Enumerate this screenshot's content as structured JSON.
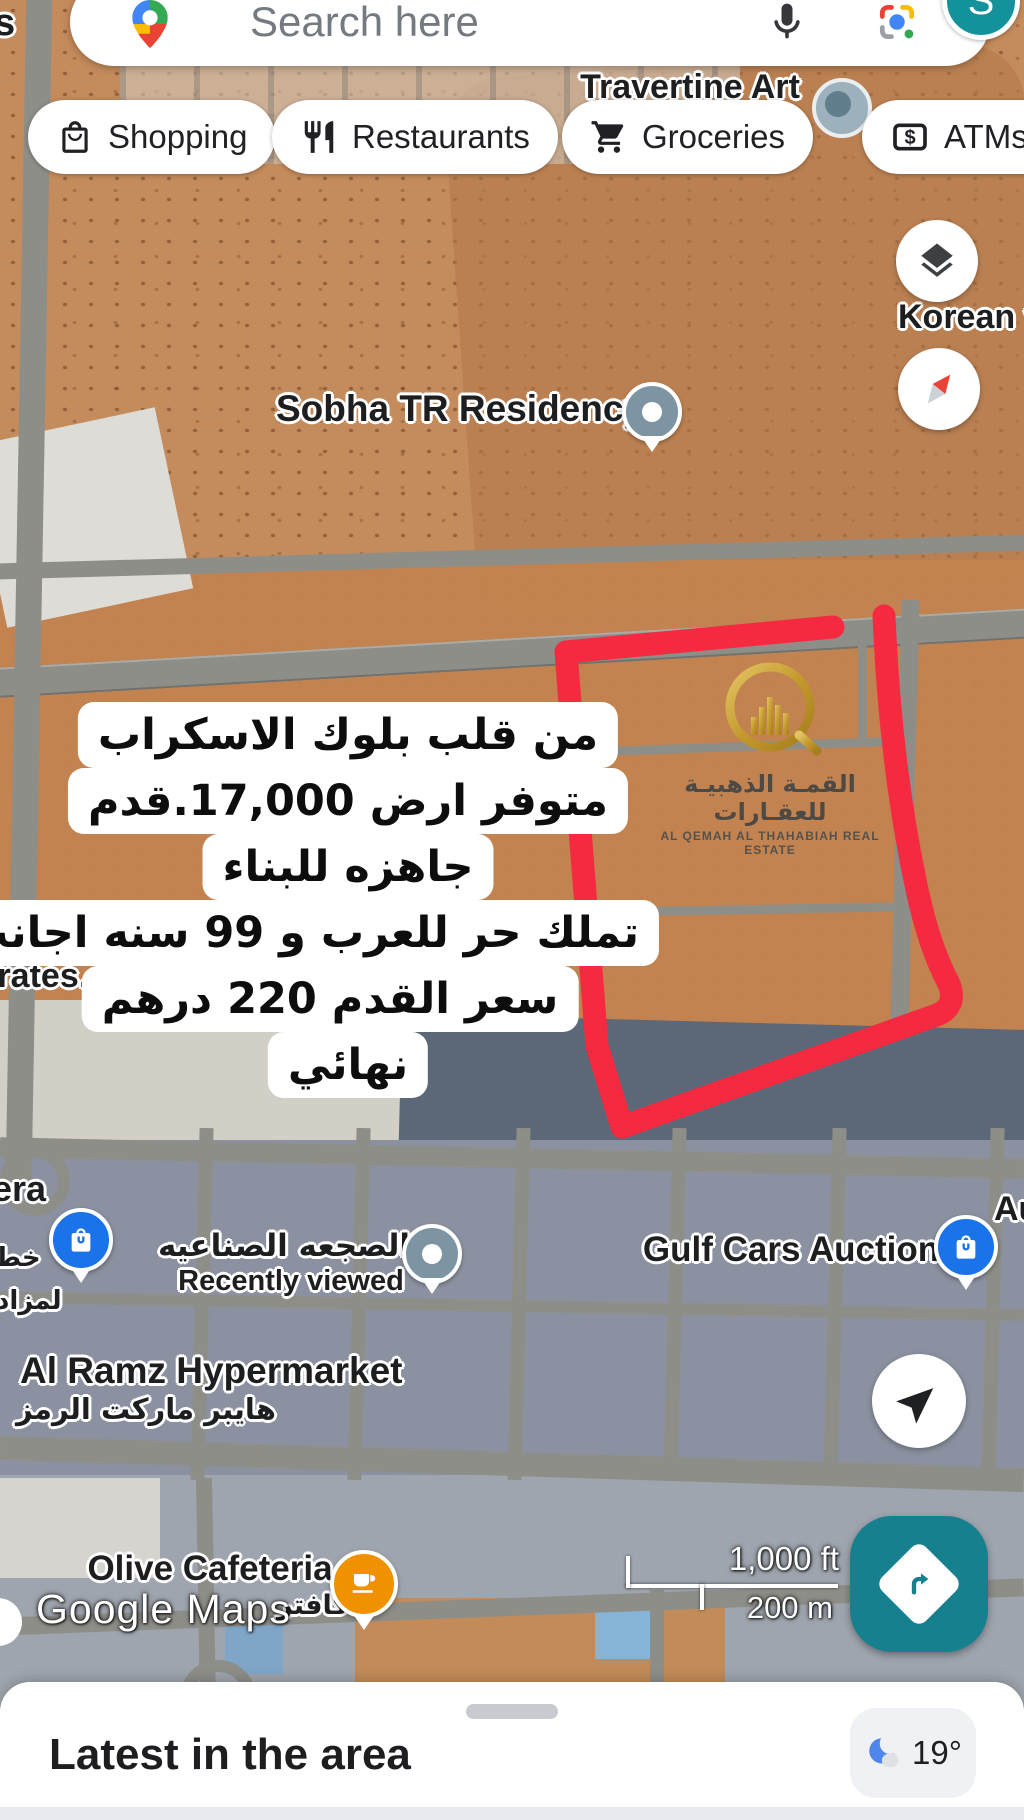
{
  "search": {
    "placeholder": "Search here",
    "avatar": "S"
  },
  "chips": {
    "shopping": "Shopping",
    "restaurants": "Restaurants",
    "groceries": "Groceries",
    "atms": "ATMs"
  },
  "labels": {
    "top_left_fragment": "s",
    "travertine": "Travertine Art",
    "la_fragment": "la",
    "korean": "Korean v",
    "sobha": "Sobha TR Residency",
    "ss_fragment": "ss",
    "irates_fragment": "irates...",
    "era_fragment": "era",
    "khat_fragment": "خط",
    "lmzad_fragment": "لمزاد",
    "sajaa_ar": "الصجعه الصناعيه",
    "recently_viewed": "Recently viewed",
    "gulf_cars": "Gulf Cars Auction",
    "au_fragment": "Au",
    "al_ramz": "Al Ramz Hypermarket",
    "al_ramz_ar": "هايبر ماركت الرمز",
    "olive": "Olive Cafeteria",
    "cafeteria_fragment": "كافتر",
    "watermark": "Google Maps"
  },
  "overlay": {
    "lines": [
      "من قلب بلوك الاسكراب",
      "متوفر ارض 17,000.قدم",
      "جاهزه للبناء",
      "تملك حر للعرب و 99 سنه اجانب",
      "سعر القدم 220 درهم",
      "نهائي"
    ]
  },
  "logo": {
    "arabic": "القمـة الذهبيـة للعقـارات",
    "english": "AL QEMAH AL THAHABIAH REAL ESTATE"
  },
  "scale": {
    "feet": "1,000 ft",
    "meters": "200 m"
  },
  "sheet": {
    "title": "Latest in the area",
    "temperature": "19°"
  },
  "icons": {
    "search_logo": "google-maps-pin-icon",
    "mic": "microphone-icon",
    "lens": "google-lens-icon",
    "layers": "layers-icon",
    "compass": "compass-icon",
    "navigate": "navigation-arrow-icon",
    "directions": "directions-icon",
    "weather": "moon-cloud-icon"
  },
  "colors": {
    "accent_teal": "#17808F",
    "highlight_red": "#F5293F",
    "google_blue": "#1A73E8",
    "pin_orange": "#F09100",
    "logo_gold": "#C9A13B"
  }
}
